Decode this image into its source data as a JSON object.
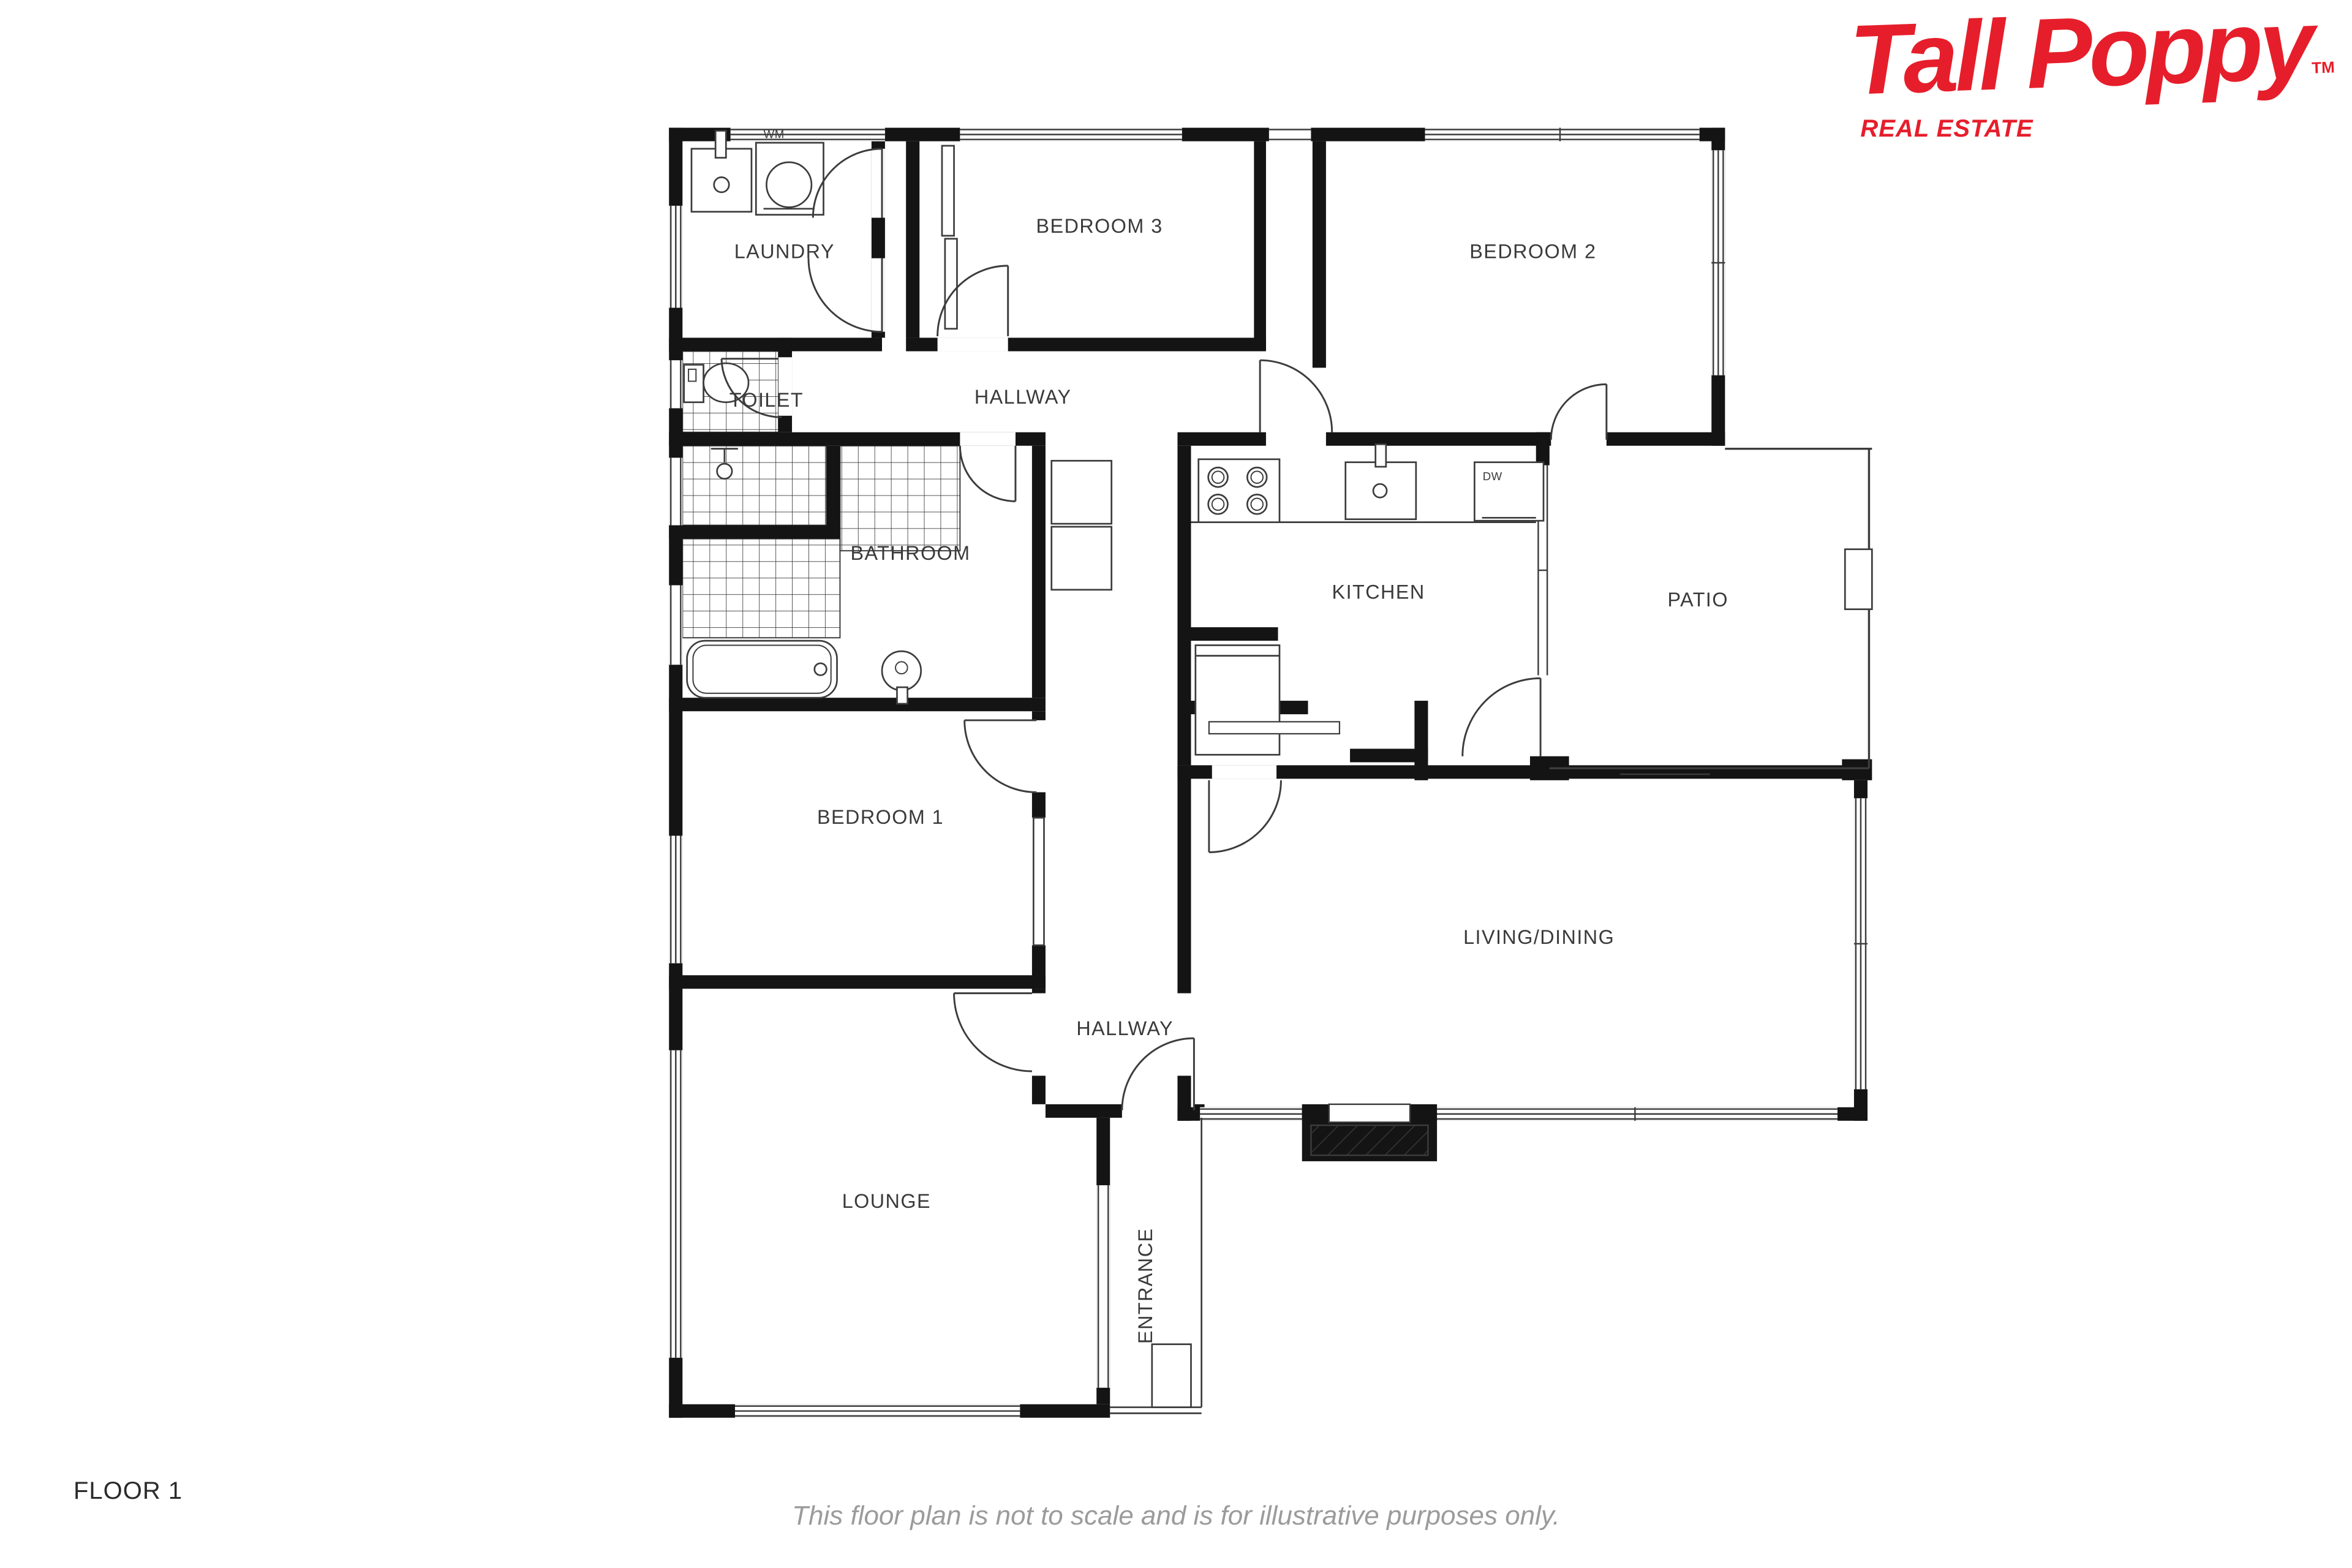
{
  "brand": {
    "name": "Tall Poppy",
    "trademark": "TM",
    "tagline": "REAL ESTATE",
    "color": "#e61e2b"
  },
  "rooms": {
    "laundry": "LAUNDRY",
    "toilet": "TOILET",
    "hallway_top": "HALLWAY",
    "bedroom3": "BEDROOM 3",
    "bedroom2": "BEDROOM 2",
    "bathroom": "BATHROOM",
    "kitchen": "KITCHEN",
    "patio": "PATIO",
    "bedroom1": "BEDROOM 1",
    "living_dining": "LIVING/DINING",
    "hallway_lower": "HALLWAY",
    "lounge": "LOUNGE",
    "entrance": "ENTRANCE"
  },
  "appliances": {
    "washing_machine": "WM",
    "dishwasher": "DW"
  },
  "footer": {
    "floor_label": "FLOOR 1",
    "disclaimer": "This floor plan is not to scale and is for illustrative purposes only."
  }
}
